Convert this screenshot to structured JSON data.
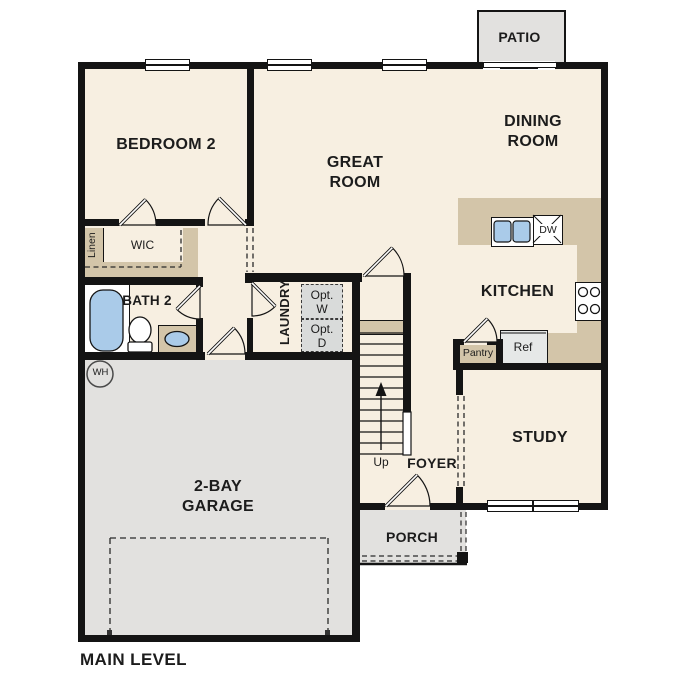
{
  "plan": {
    "level_label": "MAIN LEVEL"
  },
  "rooms": {
    "patio": "PATIO",
    "bedroom2": "BEDROOM 2",
    "great_room": "GREAT\nROOM",
    "dining_room": "DINING\nROOM",
    "kitchen": "KITCHEN",
    "bath2": "BATH 2",
    "laundry": "LAUNDRY",
    "study": "STUDY",
    "foyer": "FOYER",
    "porch": "PORCH",
    "garage": "2-BAY\nGARAGE"
  },
  "closets": {
    "wic": "WIC",
    "linen": "Linen",
    "pantry": "Pantry"
  },
  "appliances": {
    "opt_washer": "Opt.\nW",
    "opt_dryer": "Opt.\nD",
    "refrigerator": "Ref",
    "dishwasher": "DW",
    "water_heater": "WH"
  },
  "stairs": {
    "direction": "Up"
  },
  "colors": {
    "floor_cream": "#f7efe1",
    "counter_tan": "#d3c5a9",
    "concrete_gray": "#e2e1df",
    "fixture_blue": "#aacbe9",
    "wall_black": "#141414",
    "optional_appliance_gray": "#d9dbda"
  }
}
